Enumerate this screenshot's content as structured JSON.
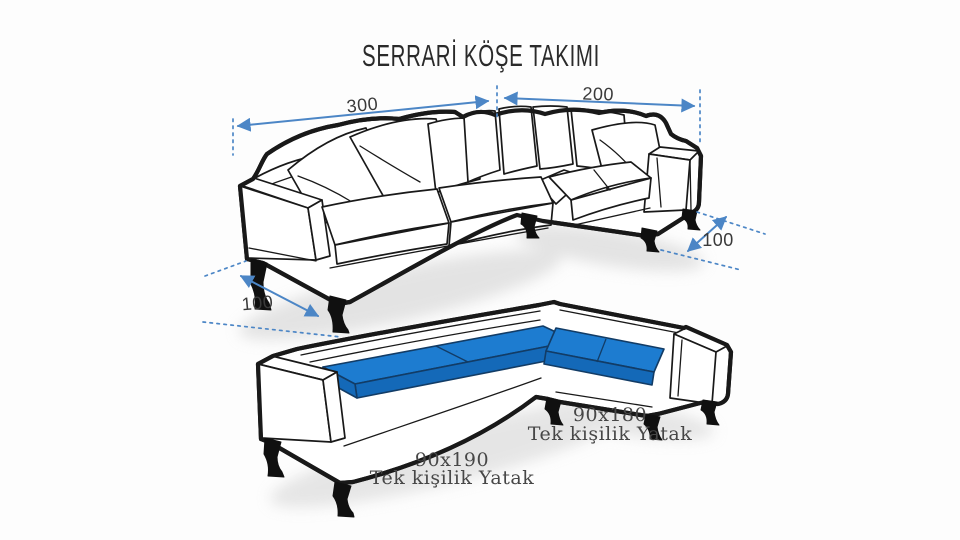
{
  "title": "SERRARİ KÖŞE TAKIMI",
  "top_view": {
    "width_left": "300",
    "width_right": "200",
    "depth_right": "100",
    "depth_left": "100"
  },
  "bed_view": {
    "left_bed": {
      "size": "90x190",
      "label": "Tek kişilik Yatak"
    },
    "right_bed": {
      "size": "90x180",
      "label": "Tek kişilik Yatak"
    }
  },
  "colors": {
    "mattress_blue": "#1d7cd0",
    "mattress_blue_dark": "#1469b8",
    "dimension_blue": "#4c86c6",
    "outline_black": "#191919",
    "label_gray": "#3a3a3a",
    "title_black": "#2a2a2a"
  }
}
